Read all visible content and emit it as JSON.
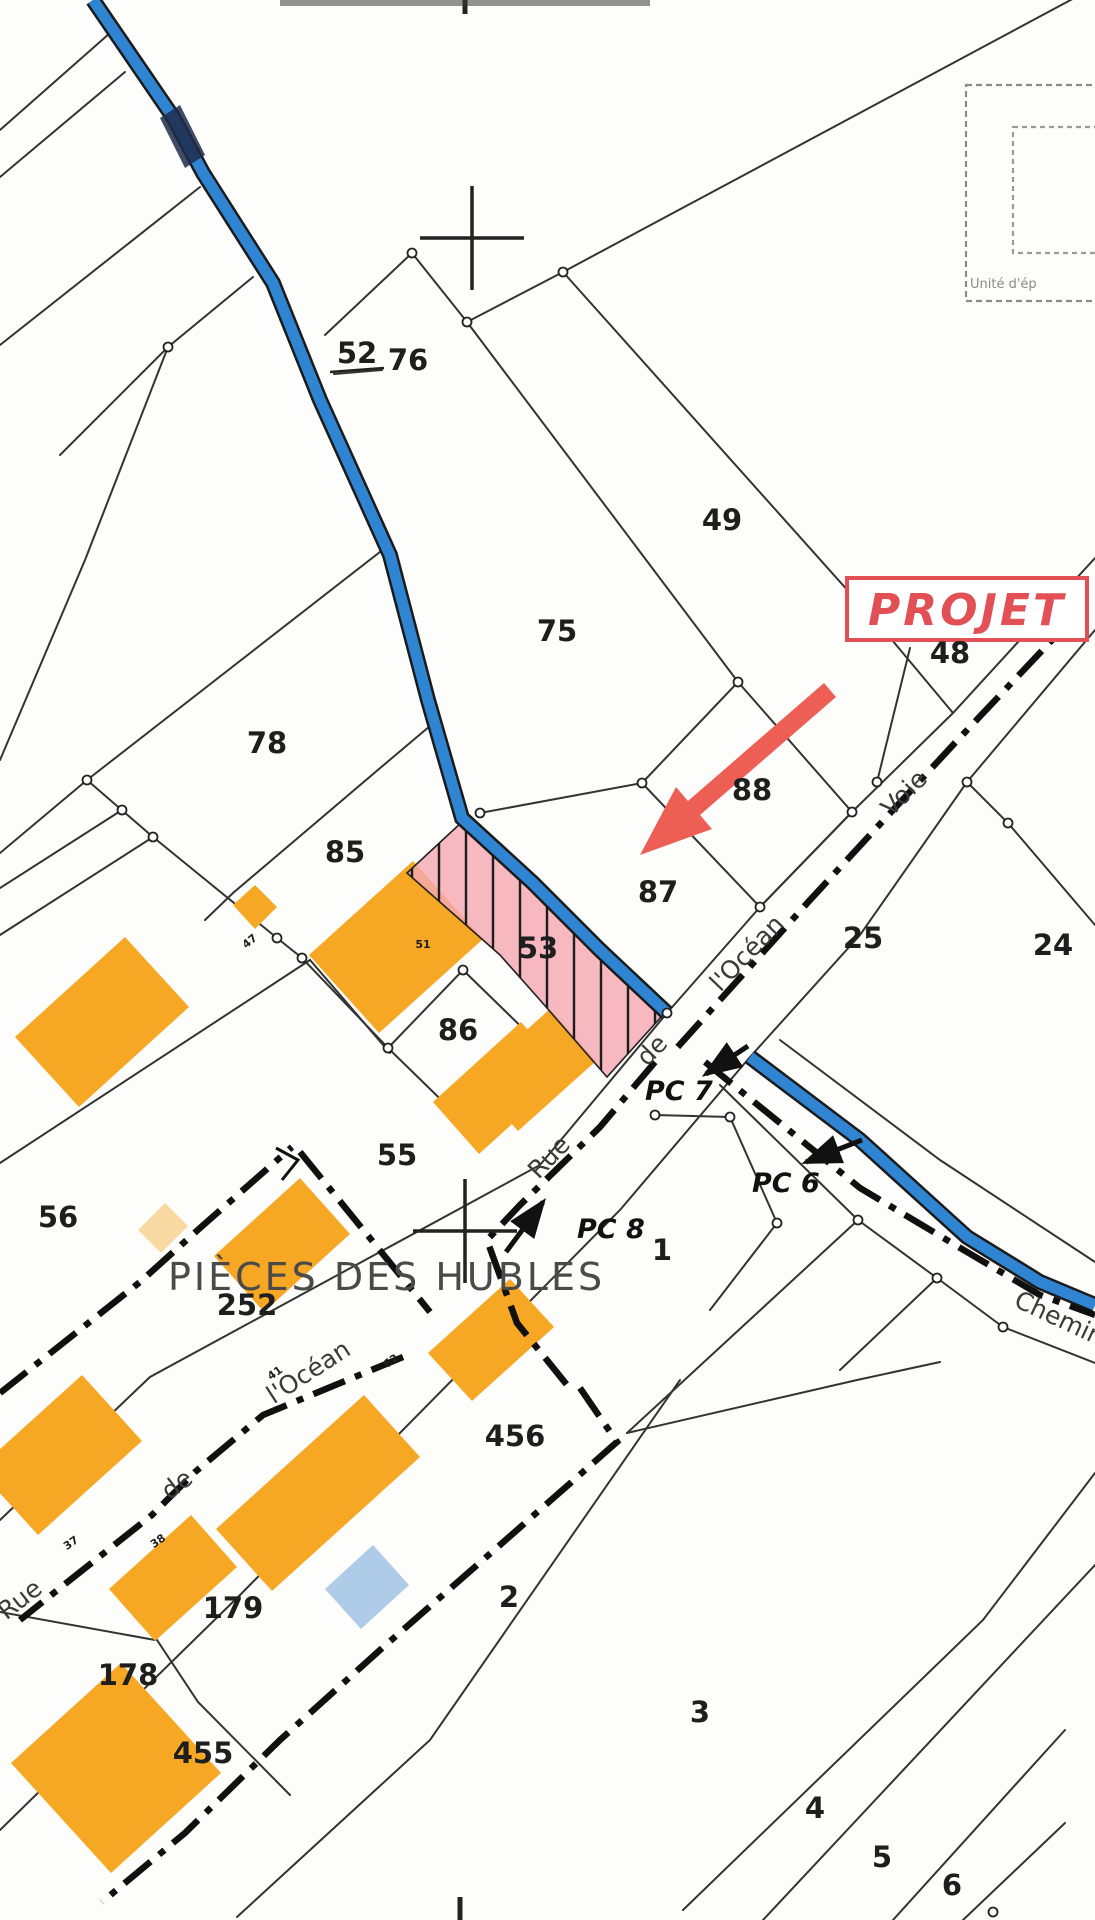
{
  "map": {
    "type": "cadastral-plan",
    "colors": {
      "paper": "#fdfdfb",
      "parcel_line": "#333333",
      "road_blue": "#2f85d2",
      "road_casing": "#1b1b1b",
      "building_orange": "#F6A723",
      "building_pale": "#F8D9A2",
      "building_blue": "#AECBE8",
      "highlight_pink": "#F5A8B2",
      "accent_red": "#ED5F55",
      "projet_red": "#E25056",
      "street_text": "#3b3b3b",
      "area_text": "#4a4a4a",
      "legend_gray": "#8a8a8a"
    },
    "labels": {
      "parcels": [
        {
          "text": "52",
          "x": 357,
          "y": 363,
          "underline": true
        },
        {
          "text": "76",
          "x": 408,
          "y": 370
        },
        {
          "text": "49",
          "x": 722,
          "y": 530
        },
        {
          "text": "75",
          "x": 557,
          "y": 641
        },
        {
          "text": "48",
          "x": 950,
          "y": 663
        },
        {
          "text": "88",
          "x": 752,
          "y": 800
        },
        {
          "text": "78",
          "x": 267,
          "y": 753
        },
        {
          "text": "85",
          "x": 345,
          "y": 862
        },
        {
          "text": "87",
          "x": 658,
          "y": 902
        },
        {
          "text": "25",
          "x": 863,
          "y": 948
        },
        {
          "text": "24",
          "x": 1053,
          "y": 955
        },
        {
          "text": "53",
          "x": 538,
          "y": 958
        },
        {
          "text": "86",
          "x": 458,
          "y": 1040
        },
        {
          "text": "55",
          "x": 397,
          "y": 1165
        },
        {
          "text": "56",
          "x": 58,
          "y": 1227
        },
        {
          "text": "1",
          "x": 662,
          "y": 1260
        },
        {
          "text": "252",
          "x": 247,
          "y": 1315
        },
        {
          "text": "456",
          "x": 515,
          "y": 1446
        },
        {
          "text": "2",
          "x": 509,
          "y": 1607
        },
        {
          "text": "179",
          "x": 233,
          "y": 1618
        },
        {
          "text": "178",
          "x": 128,
          "y": 1685
        },
        {
          "text": "455",
          "x": 203,
          "y": 1763
        },
        {
          "text": "3",
          "x": 700,
          "y": 1722
        },
        {
          "text": "4",
          "x": 815,
          "y": 1818
        },
        {
          "text": "5",
          "x": 882,
          "y": 1867
        },
        {
          "text": "6",
          "x": 952,
          "y": 1895
        }
      ],
      "small_numbers": [
        {
          "text": "47",
          "x": 252,
          "y": 944,
          "rot": -40
        },
        {
          "text": "51",
          "x": 423,
          "y": 948,
          "rot": 0
        },
        {
          "text": "62",
          "x": 393,
          "y": 1364,
          "rot": -35
        },
        {
          "text": "41",
          "x": 277,
          "y": 1376,
          "rot": -35
        },
        {
          "text": "38",
          "x": 160,
          "y": 1544,
          "rot": -35
        },
        {
          "text": "37",
          "x": 73,
          "y": 1546,
          "rot": -35
        }
      ],
      "streets": [
        {
          "text": "l'Océan",
          "x": 753,
          "y": 959,
          "rot": -46
        },
        {
          "text": "de",
          "x": 658,
          "y": 1056,
          "rot": -46
        },
        {
          "text": "Rue",
          "x": 555,
          "y": 1163,
          "rot": -46
        },
        {
          "text": "Voie",
          "x": 910,
          "y": 799,
          "rot": -45
        },
        {
          "text": "l'Océan",
          "x": 313,
          "y": 1379,
          "rot": -33
        },
        {
          "text": "de",
          "x": 182,
          "y": 1491,
          "rot": -38
        },
        {
          "text": "Rue",
          "x": 25,
          "y": 1606,
          "rot": -38
        },
        {
          "text": "Chemin",
          "x": 1056,
          "y": 1326,
          "rot": 25
        }
      ],
      "pc_marks": [
        {
          "text": "PC 7",
          "x": 645,
          "y": 1100
        },
        {
          "text": "PC 6",
          "x": 752,
          "y": 1192
        },
        {
          "text": "PC 8",
          "x": 577,
          "y": 1238
        }
      ],
      "area_name": {
        "text": "PIÈCES DES HUBLES",
        "x": 168,
        "y": 1290
      },
      "projet": {
        "text": "PROJET"
      },
      "legend_box": {
        "text": "Unité d'ép"
      }
    }
  }
}
